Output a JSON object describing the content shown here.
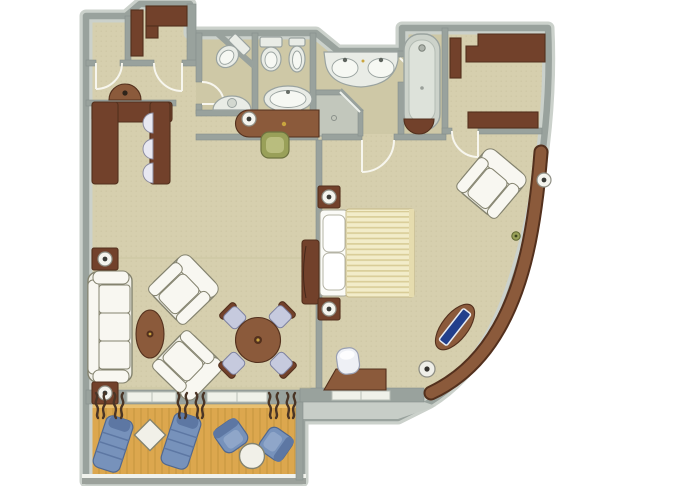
{
  "title": "Suite floor plan with balcony",
  "palette": {
    "floor": "#d6cfae",
    "floor_bath": "#cec8a6",
    "wall": "#99a29d",
    "wall_light": "#cbd1cb",
    "wood": "#8b5a3b",
    "wood_dark": "#72412b",
    "wood_deep": "#53301d",
    "white_furn": "#f1f0e8",
    "furn_stroke": "#84836f",
    "fixture": "#e9ece6",
    "fixture_stroke": "#9aa3a0",
    "shower": "#c2c7bc",
    "blue": "#7792bb",
    "lavender": "#c6cade",
    "navy": "#223f8c",
    "olive": "#99a059",
    "deck": "#dca74e",
    "deck_line": "#b98a36",
    "duvet": "#f2ecc9",
    "duvet_stripe": "#d8cc96",
    "curtain": "#4a3526",
    "railing": "#9ba19b"
  },
  "rooms": [
    {
      "name": "entry-hall",
      "furniture": [
        "console-table"
      ]
    },
    {
      "name": "closet",
      "furniture": []
    },
    {
      "name": "walk-in-closet-front",
      "furniture": [
        "wardrobe-l",
        "wardrobe-side"
      ]
    },
    {
      "name": "powder-room",
      "furniture": [
        "corner-toilet",
        "pedestal-sink"
      ]
    },
    {
      "name": "wc",
      "furniture": [
        "toilet",
        "bidet",
        "oval-sink-console"
      ]
    },
    {
      "name": "master-bathroom",
      "furniture": [
        "double-sink-vanity",
        "bathtub",
        "corner-shower"
      ]
    },
    {
      "name": "dressing-room",
      "furniture": [
        "wardrobe-left",
        "wardrobe-top",
        "wardrobe-bottom"
      ]
    },
    {
      "name": "living-room",
      "furniture": [
        "bar-counter",
        "bar-stools",
        "writing-desk",
        "desk-lamp",
        "desk-chair",
        "sofa",
        "end-table-lamps",
        "armchair-upper",
        "armchair-lower",
        "oval-coffee-table",
        "dining-table",
        "dining-chairs",
        "tv-cabinet",
        "area-rug"
      ]
    },
    {
      "name": "bedroom",
      "furniture": [
        "bed",
        "pillows",
        "nightstand-lamps",
        "armchair",
        "curved-counter",
        "counter-lamp",
        "counter-plant",
        "tv-on-counter",
        "round-stool",
        "vanity-desk",
        "vanity-stool",
        "wall-console"
      ]
    },
    {
      "name": "balcony",
      "furniture": [
        "sun-lounger-left",
        "sun-lounger-right",
        "diamond-side-table",
        "deck-armchair-left",
        "deck-armchair-right",
        "round-deck-table",
        "railing"
      ]
    }
  ],
  "counts": {
    "bar_stools": 3,
    "dining_chairs": 4,
    "sun_loungers": 2,
    "deck_armchairs": 2,
    "table_lamps": 6,
    "sinks": 4,
    "toilets": 2,
    "bidets": 1
  }
}
